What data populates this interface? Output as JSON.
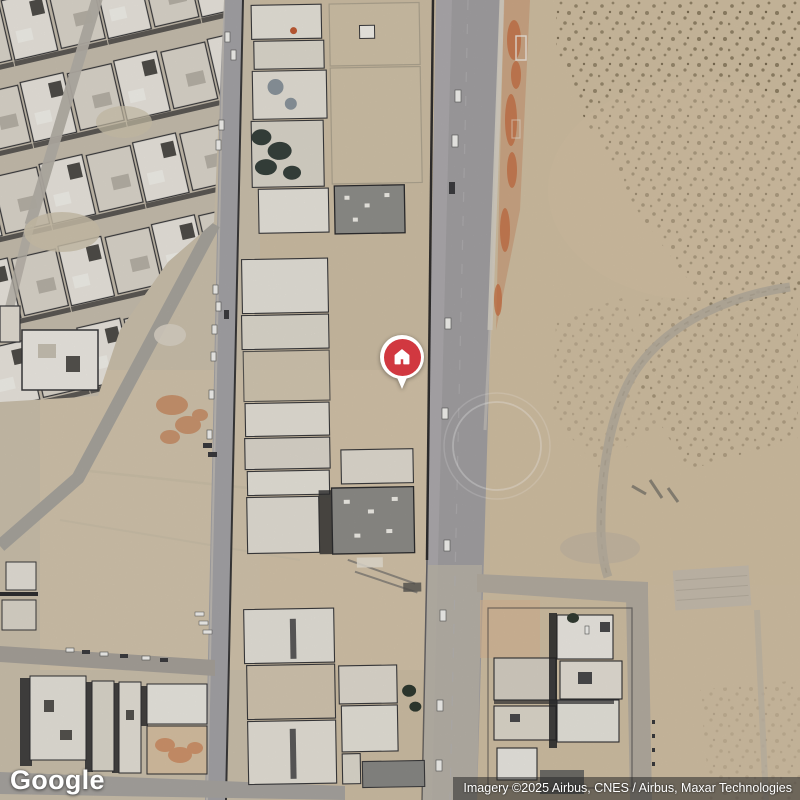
{
  "map": {
    "watermark": {
      "logo_text": "Google"
    },
    "attribution": {
      "text": "Imagery ©2025 Airbus, CNES / Airbus, Maxar Technologies"
    },
    "marker": {
      "icon": "house-icon"
    },
    "colors": {
      "marker_red": "#d13840",
      "marker_ring": "#ffffff",
      "attribution_bg": "rgba(40,40,40,0.55)",
      "attribution_text": "#ffffff",
      "sand_base": "#d0c0a6",
      "sand_right": "#d5c1a2",
      "road_asphalt": "#a4a2a4",
      "building_white": "#ebe7df",
      "building_grey": "#8f8e8a",
      "shadow_dark": "#2e2e30",
      "dirt_orange": "#c6713f"
    }
  }
}
